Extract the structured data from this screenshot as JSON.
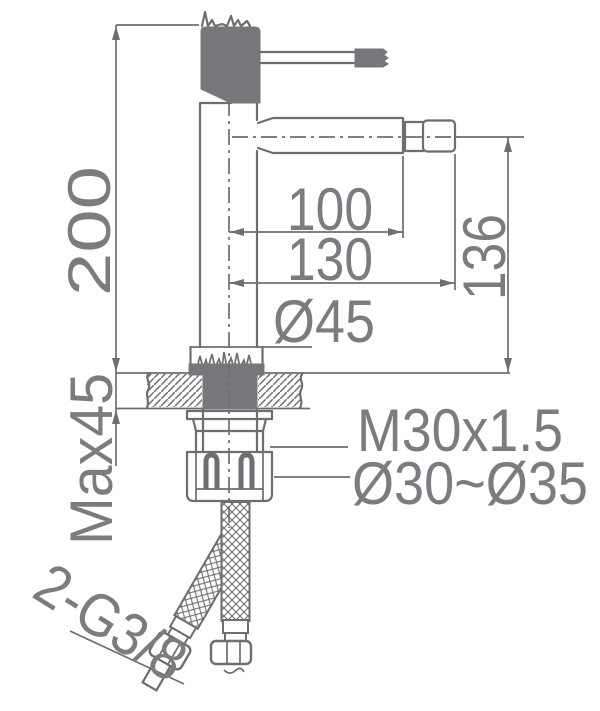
{
  "drawing": {
    "type": "faucet-installation-dimension-diagram",
    "labels": {
      "total_height": "200",
      "max_deck_thickness": "Max45",
      "spout_reach": "100",
      "total_reach": "130",
      "base_diameter": "Ø45",
      "spout_height": "136",
      "mounting_thread": "M30x1.5",
      "hole_diameter_range": "Ø30~Ø35",
      "supply_connection": "2-G3/8"
    },
    "colors": {
      "line": "#6d6e72",
      "solid_fill": "#76777b",
      "text": "#7b7c80",
      "background": "#ffffff"
    }
  }
}
